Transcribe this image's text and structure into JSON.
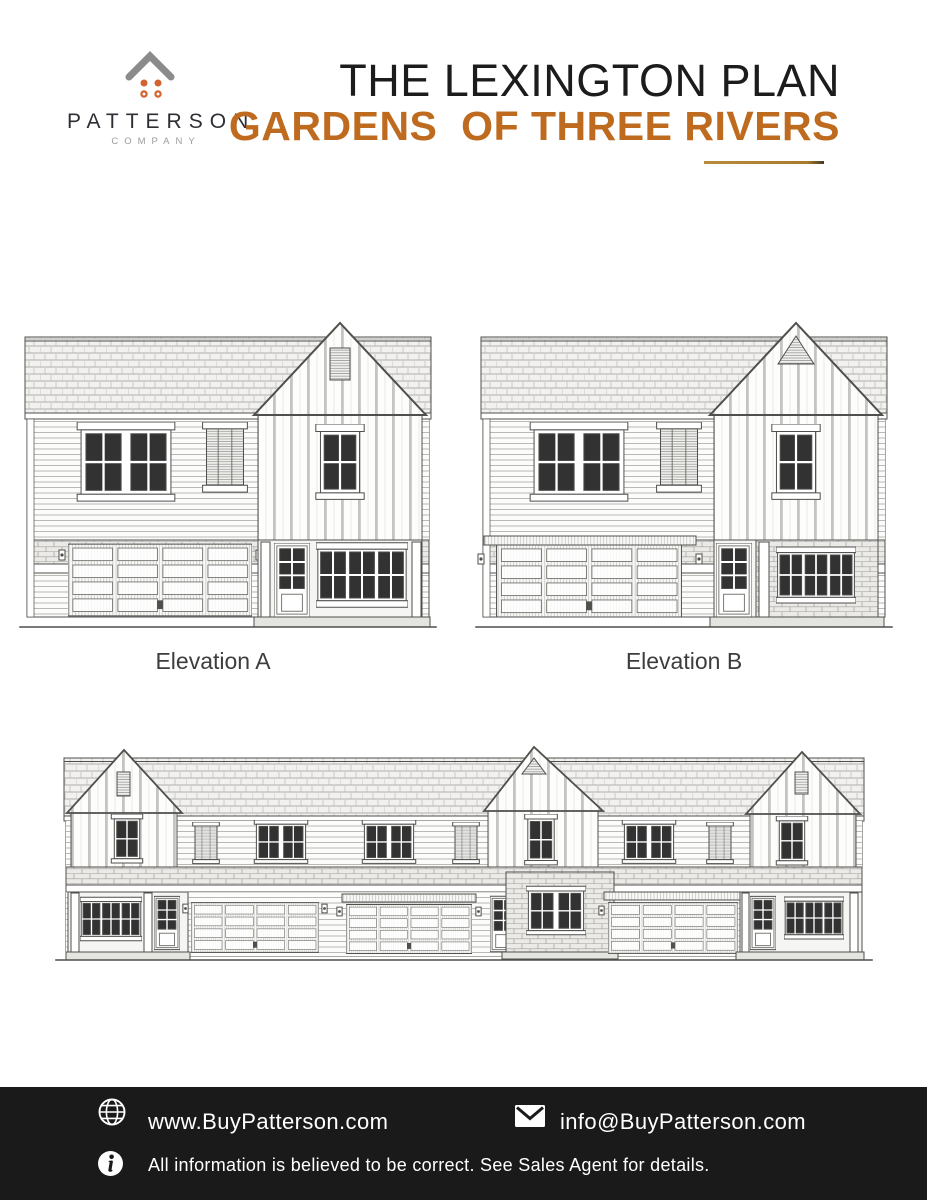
{
  "brand": {
    "logo_icon": "patterson-house-logo",
    "chevron_color": "#8b8b8b",
    "dots_color": "#d0632e",
    "name": "PATTERSON",
    "subtitle": "COMPANY"
  },
  "header": {
    "title": "THE LEXINGTON PLAN",
    "subtitle": "GARDENS  OF THREE RIVERS",
    "title_color": "#1c1c1c",
    "subtitle_color": "#bf6b1f",
    "underline_color": "#a87c2d"
  },
  "elevations": {
    "a": {
      "label": "Elevation A",
      "drawing": "single-family-elevation-a"
    },
    "b": {
      "label": "Elevation B",
      "drawing": "single-family-elevation-b"
    },
    "row": {
      "drawing": "three-unit-townhome-row-elevation"
    }
  },
  "footer": {
    "background": "#1a1a1a",
    "website": {
      "icon": "globe-icon",
      "text": "www.BuyPatterson.com"
    },
    "email": {
      "icon": "envelope-icon",
      "text": "info@BuyPatterson.com"
    },
    "disclaimer": {
      "icon": "info-icon",
      "text": "All information is believed to be correct. See Sales Agent for details."
    }
  }
}
